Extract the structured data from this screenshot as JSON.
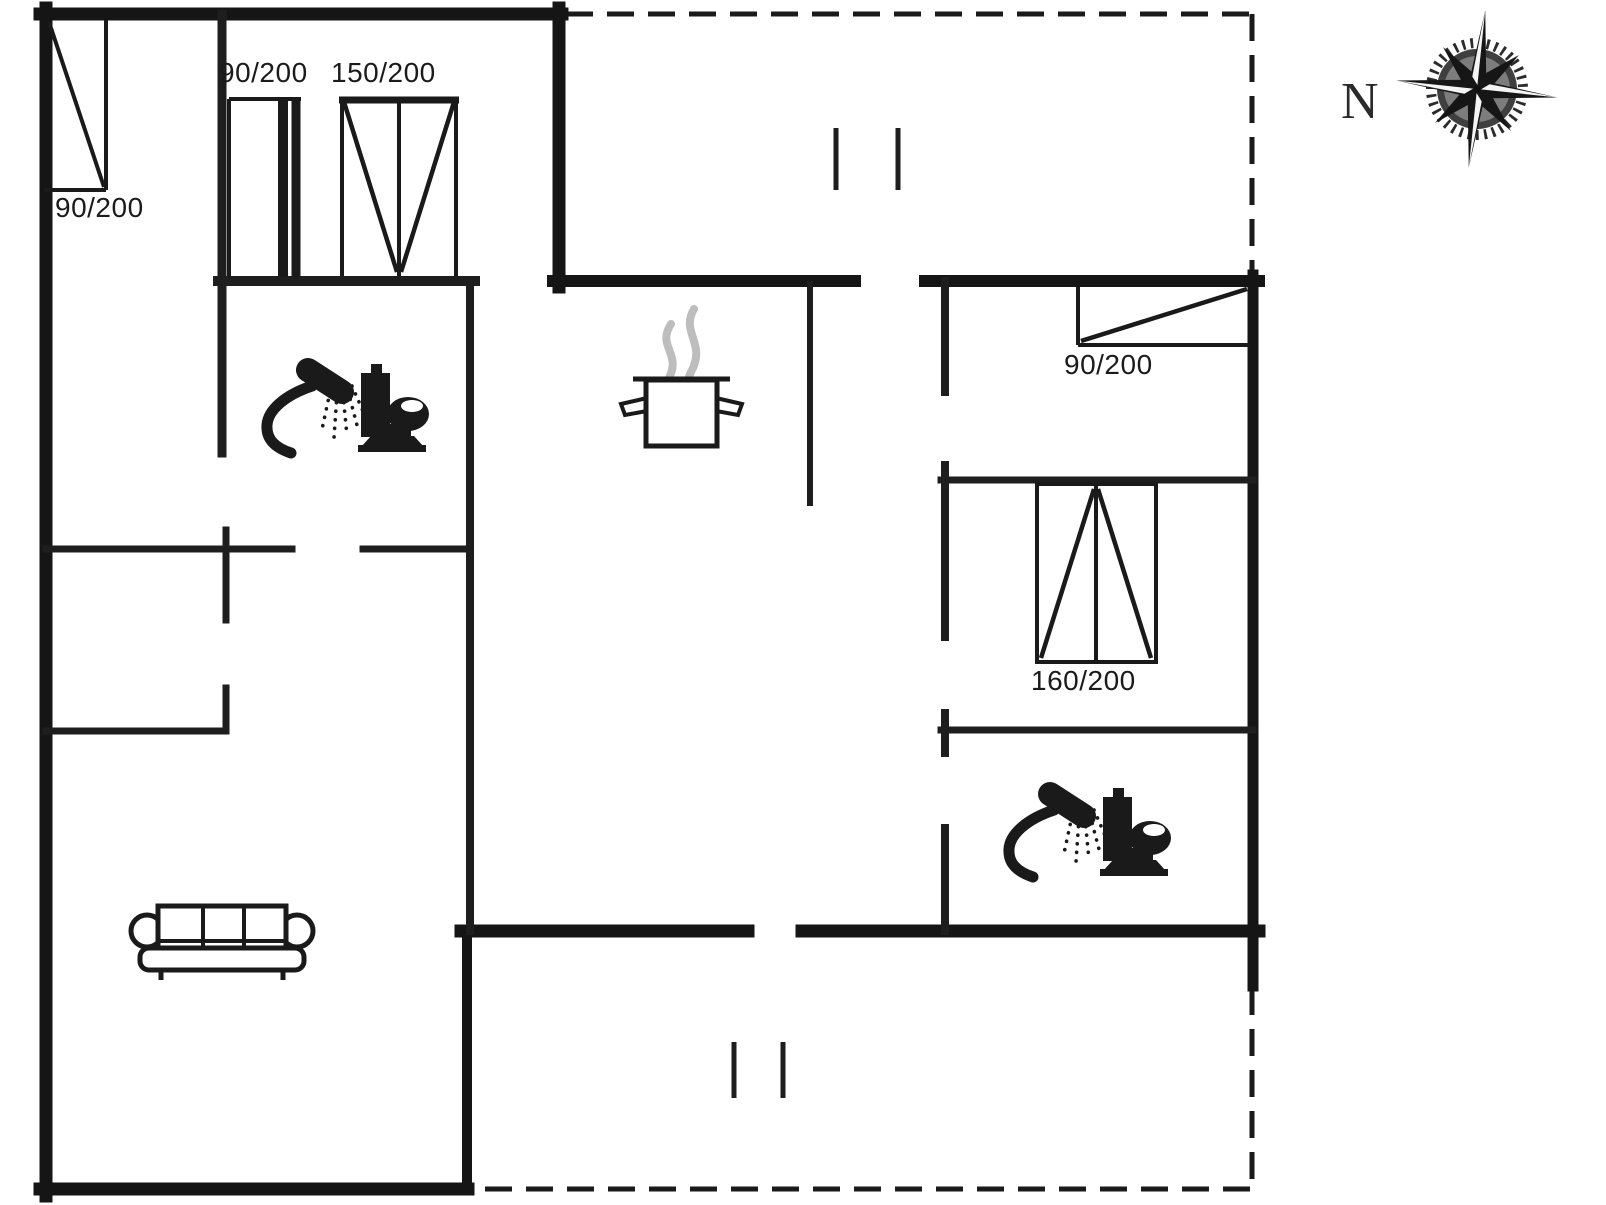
{
  "plan_title": "holiday-house-floor-plan",
  "colors": {
    "background": "#ffffff",
    "walls": "#151515",
    "interior_walls": "#1e1e1e",
    "symbols": "#1a1a1a",
    "steam": "#bdbdbd"
  },
  "compass": {
    "north_label": "N"
  },
  "openings": {
    "entrance_door": {
      "label": "90/200"
    },
    "interior_door": {
      "label": "90/200"
    },
    "window_150": {
      "label": "150/200"
    },
    "window_right_90": {
      "label": "90/200"
    },
    "bed_160": {
      "label": "160/200"
    }
  }
}
